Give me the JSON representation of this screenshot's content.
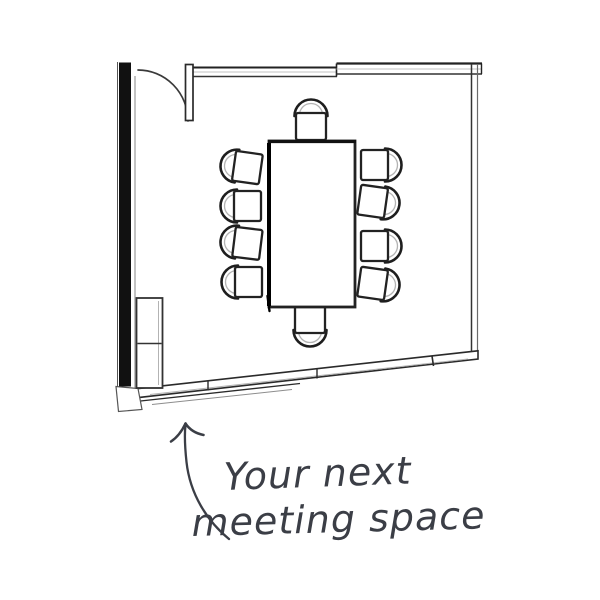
{
  "annotation": {
    "line1": "Your next",
    "line2": "meeting space"
  },
  "floor_plan": {
    "label": "Hand-sketched meeting room floor plan",
    "chair_count": 10,
    "elements": [
      "conference-table",
      "chairs",
      "door",
      "door-swing-arc",
      "sideboard-cabinet",
      "walls"
    ],
    "colors": {
      "ink": "#1e1e1e",
      "faint": "#b3b3b3",
      "annotation_text": "#3b3e46",
      "background": "#ffffff"
    }
  }
}
